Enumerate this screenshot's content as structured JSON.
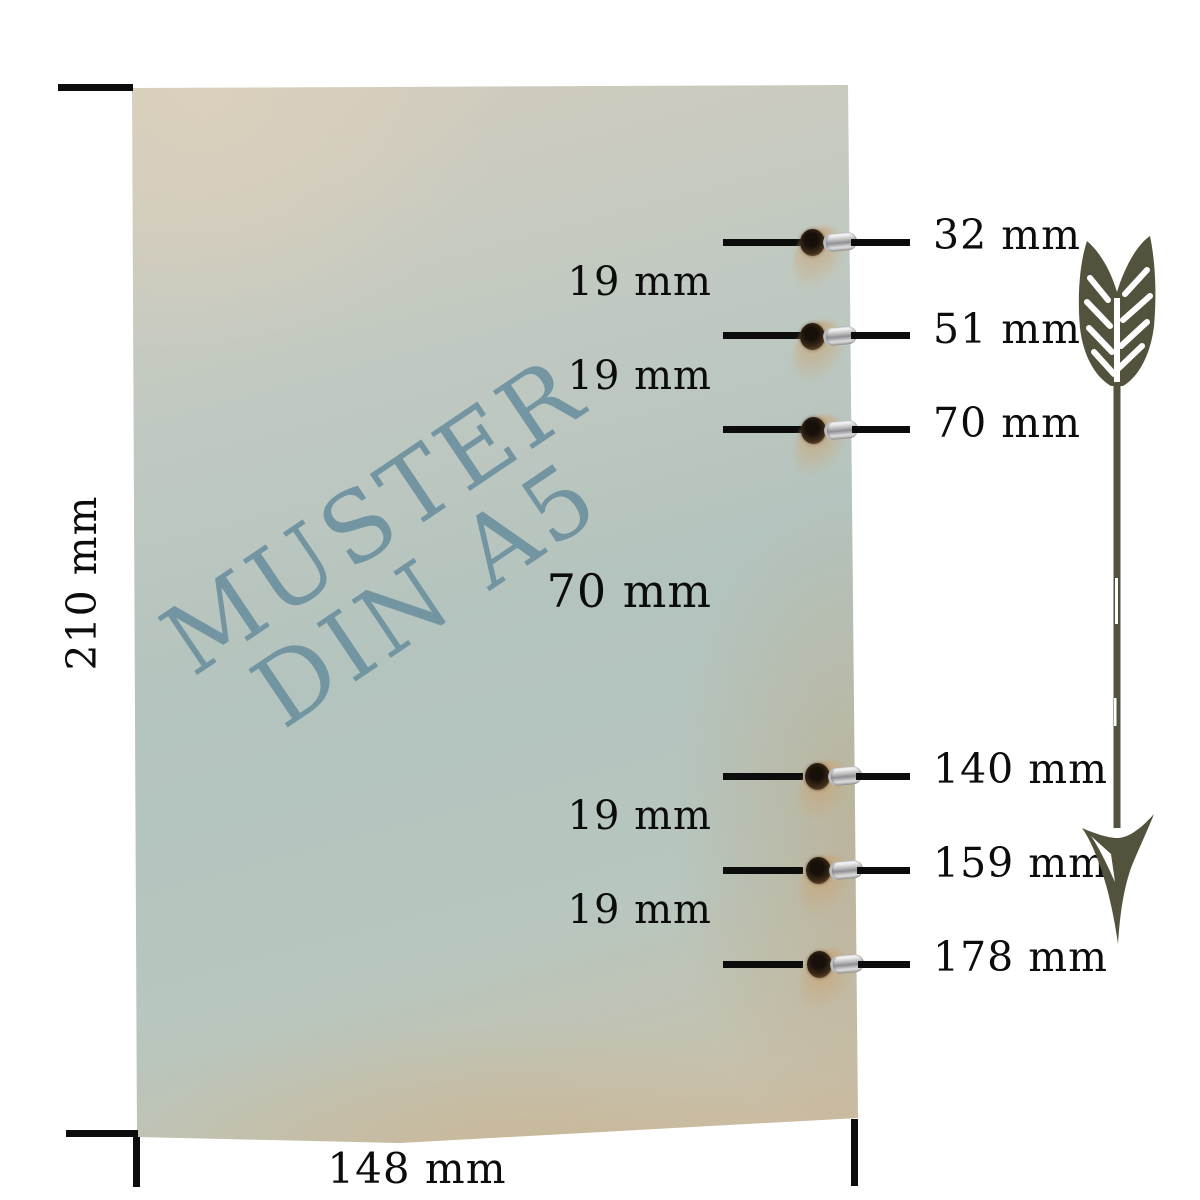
{
  "paper": {
    "watermark_line1": "MUSTER",
    "watermark_line2": "DIN A5",
    "watermark_color": "#6a8f9f"
  },
  "dimensions": {
    "height_label": "210 mm",
    "width_label": "148 mm"
  },
  "holes": [
    {
      "mm": 32,
      "label": "32 mm"
    },
    {
      "mm": 51,
      "label": "51 mm"
    },
    {
      "mm": 70,
      "label": "70 mm"
    },
    {
      "mm": 140,
      "label": "140 mm"
    },
    {
      "mm": 159,
      "label": "159 mm"
    },
    {
      "mm": 178,
      "label": "178 mm"
    }
  ],
  "gaps": [
    {
      "label": "19 mm",
      "between": [
        0,
        1
      ],
      "large": false
    },
    {
      "label": "19 mm",
      "between": [
        1,
        2
      ],
      "large": false
    },
    {
      "label": "70 mm",
      "between": [
        2,
        3
      ],
      "large": true
    },
    {
      "label": "19 mm",
      "between": [
        3,
        4
      ],
      "large": false
    },
    {
      "label": "19 mm",
      "between": [
        4,
        5
      ],
      "large": false
    }
  ],
  "colors": {
    "annotation_line": "#0c0c0c",
    "arrow": "#53523c",
    "paper_blue": "#b3c3bd",
    "paper_beige": "#d5ccbd",
    "paper_tan": "#cdbaa0",
    "eyelet_metal": "#cfcfcf",
    "hole_brown": "#3c2a18"
  }
}
